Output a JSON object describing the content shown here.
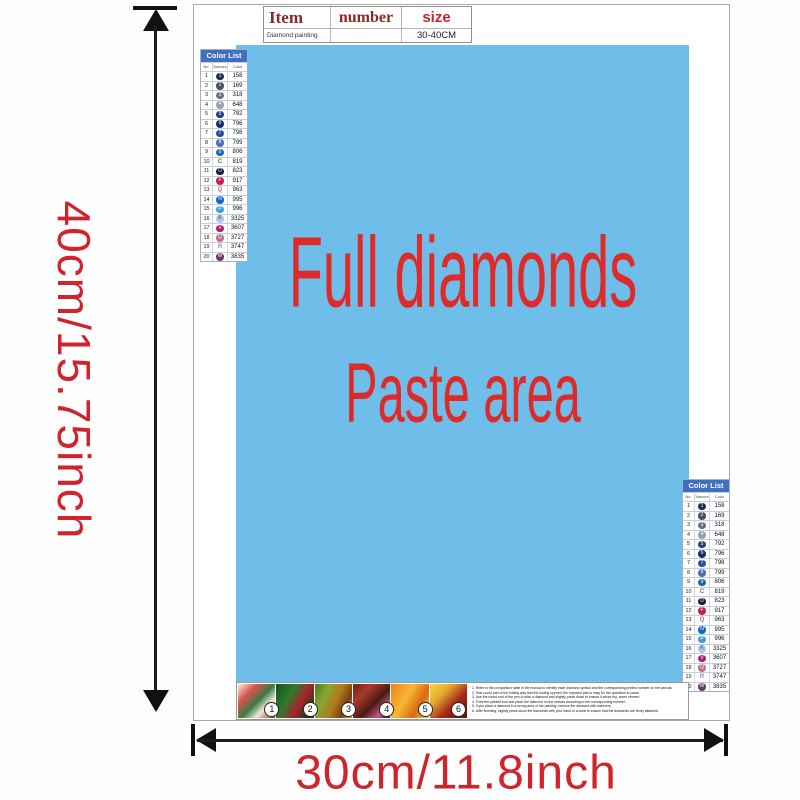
{
  "dimensions": {
    "height_label": "40cm/15.75inch",
    "width_label": "30cm/11.8inch"
  },
  "item_table": {
    "col_item": "Item",
    "col_number": "number",
    "col_size": "size",
    "row_item": "Diamond painting",
    "row_number": "",
    "row_size": "30-40CM"
  },
  "paste_area": {
    "line1": "Full diamonds",
    "line2": "Paste area"
  },
  "color_list": {
    "title": "Color List",
    "col_no": "No.",
    "col_diamond": "Diamond",
    "col_color": "Color",
    "rows": [
      {
        "no": "1",
        "glyph": "1",
        "code": "158",
        "bg": "#1c2b5a",
        "fg": "#ffffff",
        "circle": true
      },
      {
        "no": "2",
        "glyph": "2",
        "code": "169",
        "bg": "#4a4f63",
        "fg": "#ffffff",
        "circle": true
      },
      {
        "no": "3",
        "glyph": "3",
        "code": "318",
        "bg": "#6a7080",
        "fg": "#ffffff",
        "circle": true
      },
      {
        "no": "4",
        "glyph": "4",
        "code": "648",
        "bg": "#9aa0aa",
        "fg": "#ffffff",
        "circle": true
      },
      {
        "no": "5",
        "glyph": "5",
        "code": "792",
        "bg": "#24407e",
        "fg": "#ffffff",
        "circle": true
      },
      {
        "no": "6",
        "glyph": "6",
        "code": "796",
        "bg": "#16306e",
        "fg": "#ffffff",
        "circle": true
      },
      {
        "no": "7",
        "glyph": "7",
        "code": "798",
        "bg": "#2a4e9e",
        "fg": "#ffffff",
        "circle": true
      },
      {
        "no": "8",
        "glyph": "8",
        "code": "799",
        "bg": "#4a6fb5",
        "fg": "#ffffff",
        "circle": true
      },
      {
        "no": "9",
        "glyph": "9",
        "code": "806",
        "bg": "#1f66a8",
        "fg": "#ffffff",
        "circle": true
      },
      {
        "no": "10",
        "glyph": "C",
        "code": "819",
        "bg": "",
        "fg": "#666666",
        "circle": false
      },
      {
        "no": "11",
        "glyph": "D",
        "code": "823",
        "bg": "#121c3e",
        "fg": "#ffffff",
        "circle": true
      },
      {
        "no": "12",
        "glyph": "F",
        "code": "917",
        "bg": "#c02050",
        "fg": "#ffffff",
        "circle": true
      },
      {
        "no": "13",
        "glyph": "Q",
        "code": "963",
        "bg": "",
        "fg": "#b06a7a",
        "circle": false
      },
      {
        "no": "14",
        "glyph": "N",
        "code": "995",
        "bg": "#1565c8",
        "fg": "#ffffff",
        "circle": true
      },
      {
        "no": "15",
        "glyph": "P",
        "code": "996",
        "bg": "#3aa0dc",
        "fg": "#ffffff",
        "circle": true
      },
      {
        "no": "16",
        "glyph": "K",
        "code": "3325",
        "bg": "#a9c9e9",
        "fg": "#35507a",
        "circle": true
      },
      {
        "no": "17",
        "glyph": "V",
        "code": "3607",
        "bg": "#b01e72",
        "fg": "#ffffff",
        "circle": true
      },
      {
        "no": "18",
        "glyph": "Q",
        "code": "3727",
        "bg": "#b8738f",
        "fg": "#ffffff",
        "circle": true
      },
      {
        "no": "19",
        "glyph": "R",
        "code": "3747",
        "bg": "",
        "fg": "#8f86b8",
        "circle": false
      },
      {
        "no": "20",
        "glyph": "W",
        "code": "3835",
        "bg": "#6d3a66",
        "fg": "#ffffff",
        "circle": true
      }
    ]
  },
  "steps": [
    {
      "num": "1"
    },
    {
      "num": "2"
    },
    {
      "num": "3"
    },
    {
      "num": "4"
    },
    {
      "num": "5"
    },
    {
      "num": "6"
    }
  ],
  "instructions": {
    "lines": [
      "1. Refer to the comparison table in the manual to identify each diamond symbol and the corresponding printed number on the canvas.",
      "2. Tear round part of the folding way that the folding opened; the exposed part is easy for the operation to paste.",
      "3. Use the round end of the pen to stick a diamond and slightly press down to ensure it sticks dry; some cement.",
      "4. Point the painted tool and place the diamond on the canvas according to the corresponding number.",
      "5. If you place a diamond in a wrong area of the painting, remove the diamond with tweezers.",
      "6. After finishing, slightly press down the diamonds with your hand or a book to ensure that the diamonds are firmly attached."
    ]
  },
  "colors": {
    "dimension_label_red": "#d0232b",
    "paste_area_blue": "#6fbde9",
    "paste_text_red": "#de2a28",
    "color_list_header_blue": "#3f6fc1",
    "item_header_maroon": "#8b2a21",
    "size_header_red": "#c3242a"
  }
}
